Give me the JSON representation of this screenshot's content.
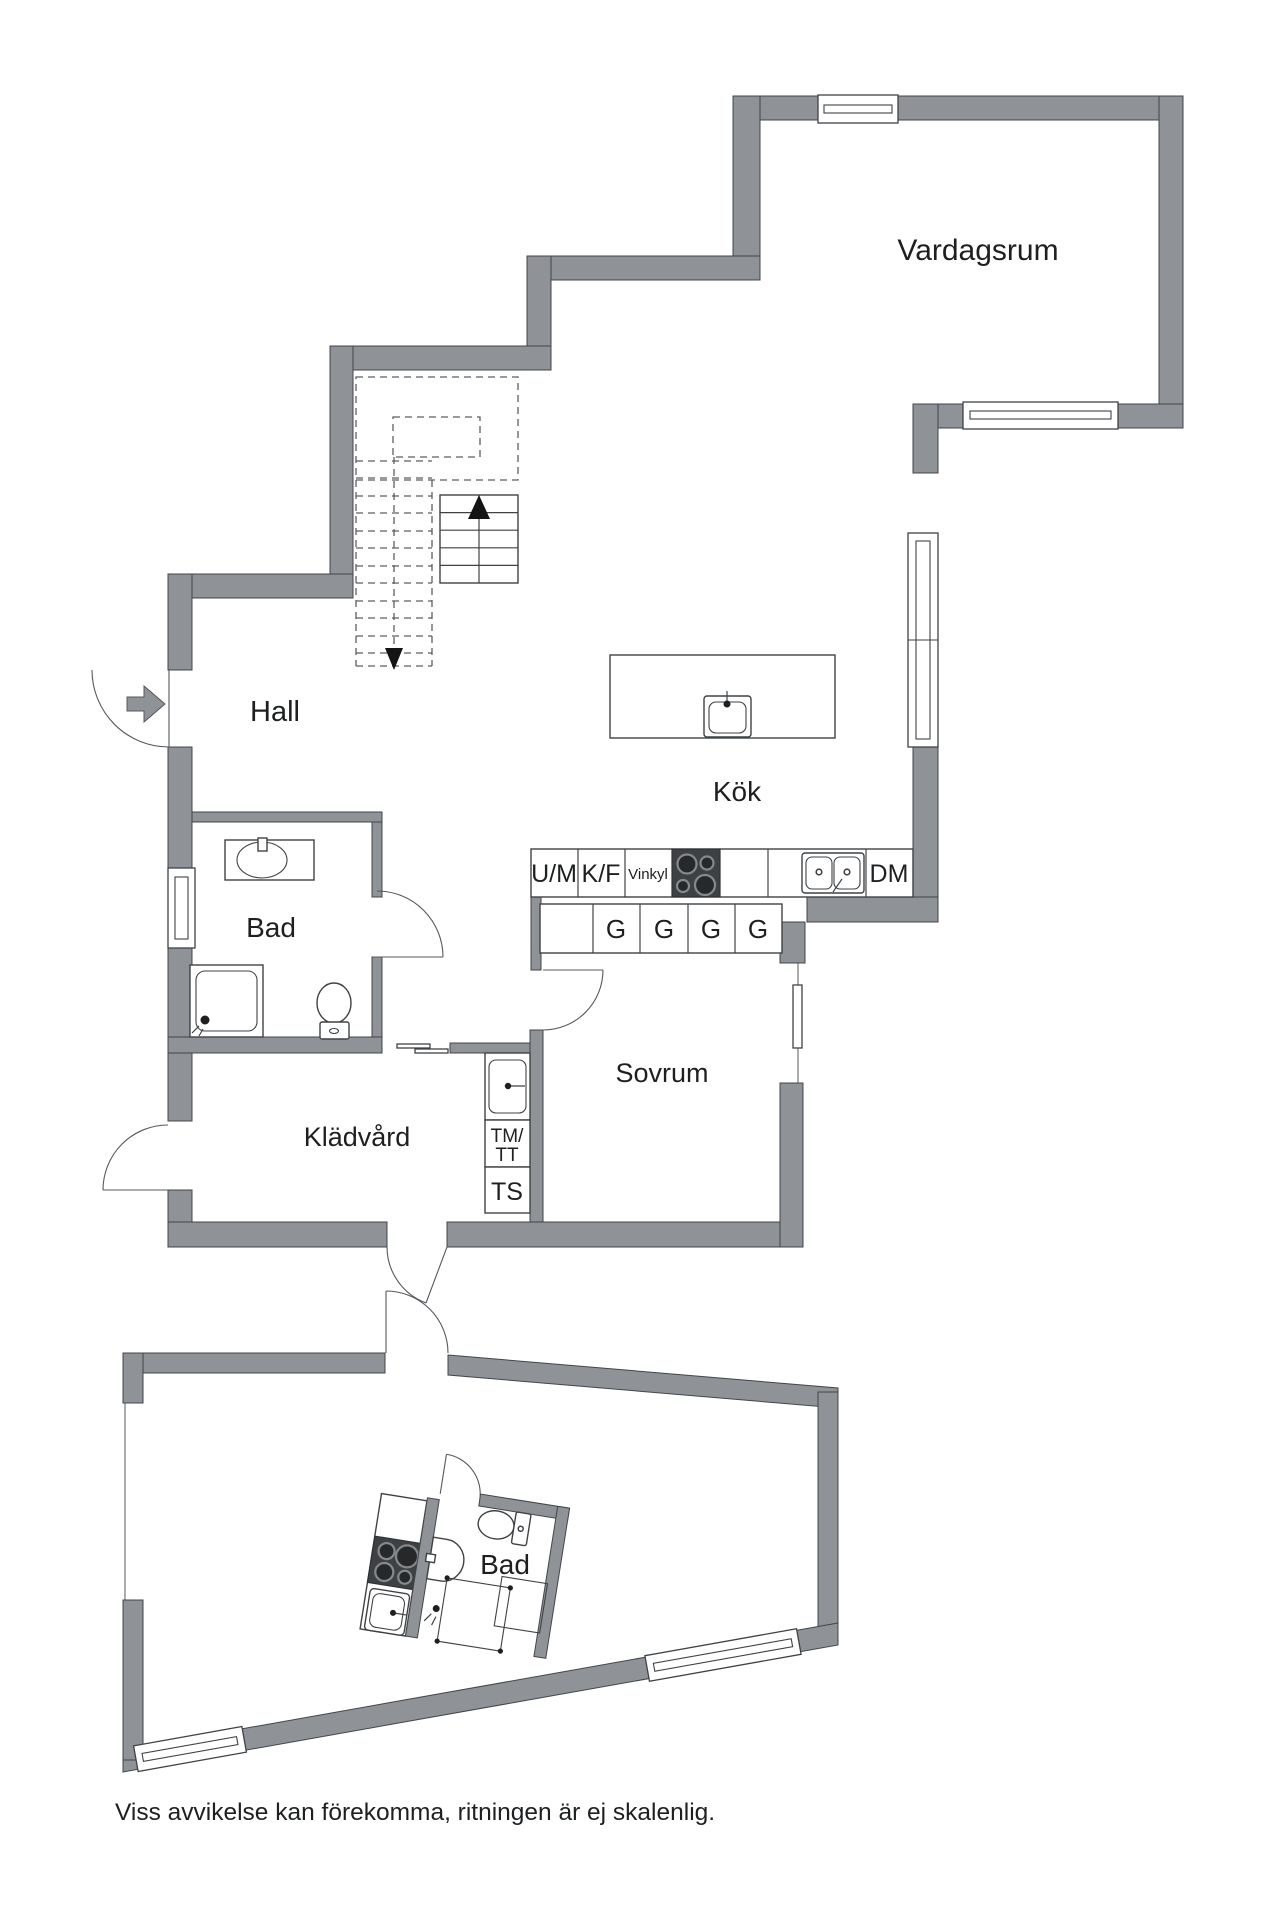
{
  "floorplan": {
    "rooms": {
      "living_room": "Vardagsrum",
      "hall": "Hall",
      "kitchen": "Kök",
      "bathroom_upper": "Bad",
      "bedroom": "Sovrum",
      "laundry": "Klädvård",
      "bathroom_lower": "Bad"
    },
    "kitchen_units": {
      "um": "U/M",
      "kf": "K/F",
      "vinkyl": "Vinkyl",
      "dm": "DM",
      "cabinets": [
        "G",
        "G",
        "G",
        "G"
      ]
    },
    "laundry_units": {
      "tm_tt_line1": "TM/",
      "tm_tt_line2": "TT",
      "ts": "TS"
    },
    "disclaimer": "Viss avvikelse kan förekomma, ritningen är ej skalenlig.",
    "colors": {
      "wall": "#8f9397",
      "line": "#3f4245",
      "appliance_dark": "#3e4144",
      "stair_arrow": "#141414"
    }
  }
}
